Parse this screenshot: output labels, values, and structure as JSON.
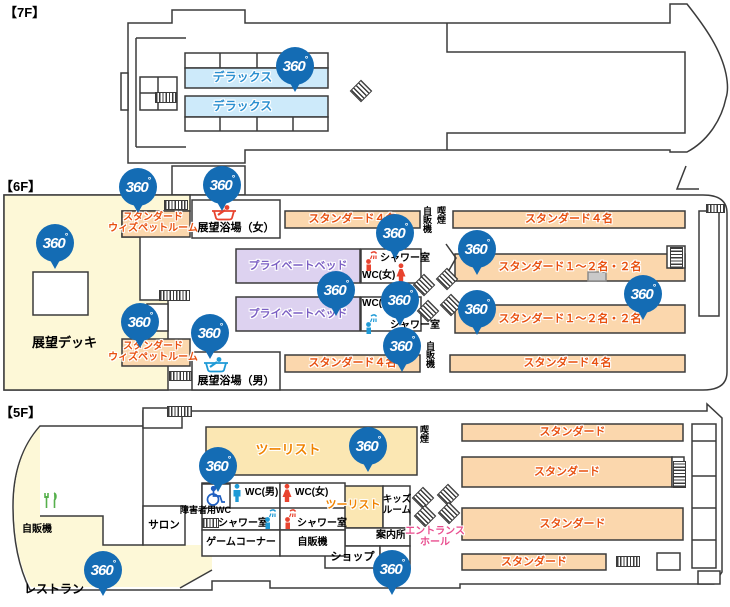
{
  "badge": {
    "text": "360",
    "degree": "°"
  },
  "colors": {
    "badge_blue": "#146cb4",
    "line": "#3b3b3b",
    "room_orange_bg": "#fbd7ad",
    "room_text_red": "#e8500f",
    "deluxe_bg": "#cdeafa",
    "deluxe_text": "#2b8fd0",
    "private_bg": "#ddd2f0",
    "private_text": "#7b5fc3",
    "deck_cream": "#fdf8d7",
    "tourist_bg": "#fbe7b3",
    "tourist_text": "#f08300",
    "entrance_pink": "#e94e8f",
    "icon_red": "#e8432e",
    "icon_blue": "#1e9ad6",
    "icon_green": "#56b04c",
    "wheelchair_blue": "#1f5fc0"
  },
  "floors": {
    "f7": {
      "label": "【7F】",
      "deluxe": "デラックス"
    },
    "f6": {
      "label": "【6F】",
      "deck": "展望デッキ",
      "pet_room_line1": "スタンダード",
      "pet_room_line2": "ウィズペットルーム",
      "bath_women": "展望浴場（女）",
      "bath_men": "展望浴場（男）",
      "std4": "スタンダード４名",
      "std12": "スタンダード１～２名・２名",
      "private_bed": "プライベートベッド",
      "shower": "シャワー室",
      "wc_women": "WC(女)",
      "wc_men": "WC(男)",
      "vending": "自販機",
      "smoking": "喫煙"
    },
    "f5": {
      "label": "【5F】",
      "restaurant": "レストラン",
      "vending_left": "自販機",
      "salon": "サロン",
      "tourist": "ツーリスト",
      "accessible_wc": "障害者用WC",
      "wc_men": "WC(男)",
      "wc_women": "WC(女)",
      "shower": "シャワー室",
      "game_corner": "ゲームコーナー",
      "vending_mid": "自販機",
      "shop": "ショップ",
      "info_desk": "案内所",
      "kids_room_line1": "キッズ",
      "kids_room_line2": "ルーム",
      "entrance_line1": "エントランス",
      "entrance_line2": "ホール",
      "smoking": "喫煙",
      "standard": "スタンダード"
    }
  }
}
